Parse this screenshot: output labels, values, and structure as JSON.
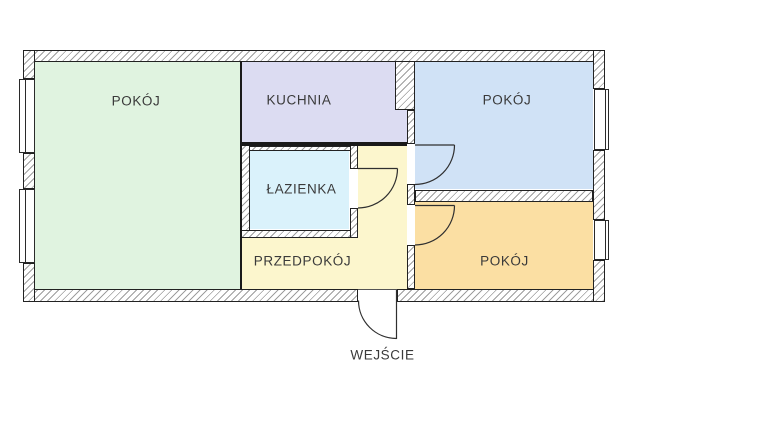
{
  "plan": {
    "type": "apartment-floor-plan",
    "rooms": {
      "living": {
        "label": "POKÓJ",
        "color": "#e0f3e0"
      },
      "kitchen": {
        "label": "KUCHNIA",
        "color": "#dcdcf2"
      },
      "bedroom_top": {
        "label": "POKÓJ",
        "color": "#d0e2f6"
      },
      "bathroom": {
        "label": "ŁAZIENKA",
        "color": "#daf2fb"
      },
      "hallway": {
        "label": "PRZEDPOKÓJ",
        "color": "#fcf6cd"
      },
      "bedroom_bottom": {
        "label": "POKÓJ",
        "color": "#fbdfa3"
      }
    },
    "entrance": {
      "label": "WEJŚCIE"
    },
    "style": {
      "wall_outline": "#222222",
      "hatch_color": "#9e9e9e",
      "label_color": "#3a3a3a",
      "door_stroke": "#2f2f2f",
      "background": "#ffffff"
    }
  }
}
